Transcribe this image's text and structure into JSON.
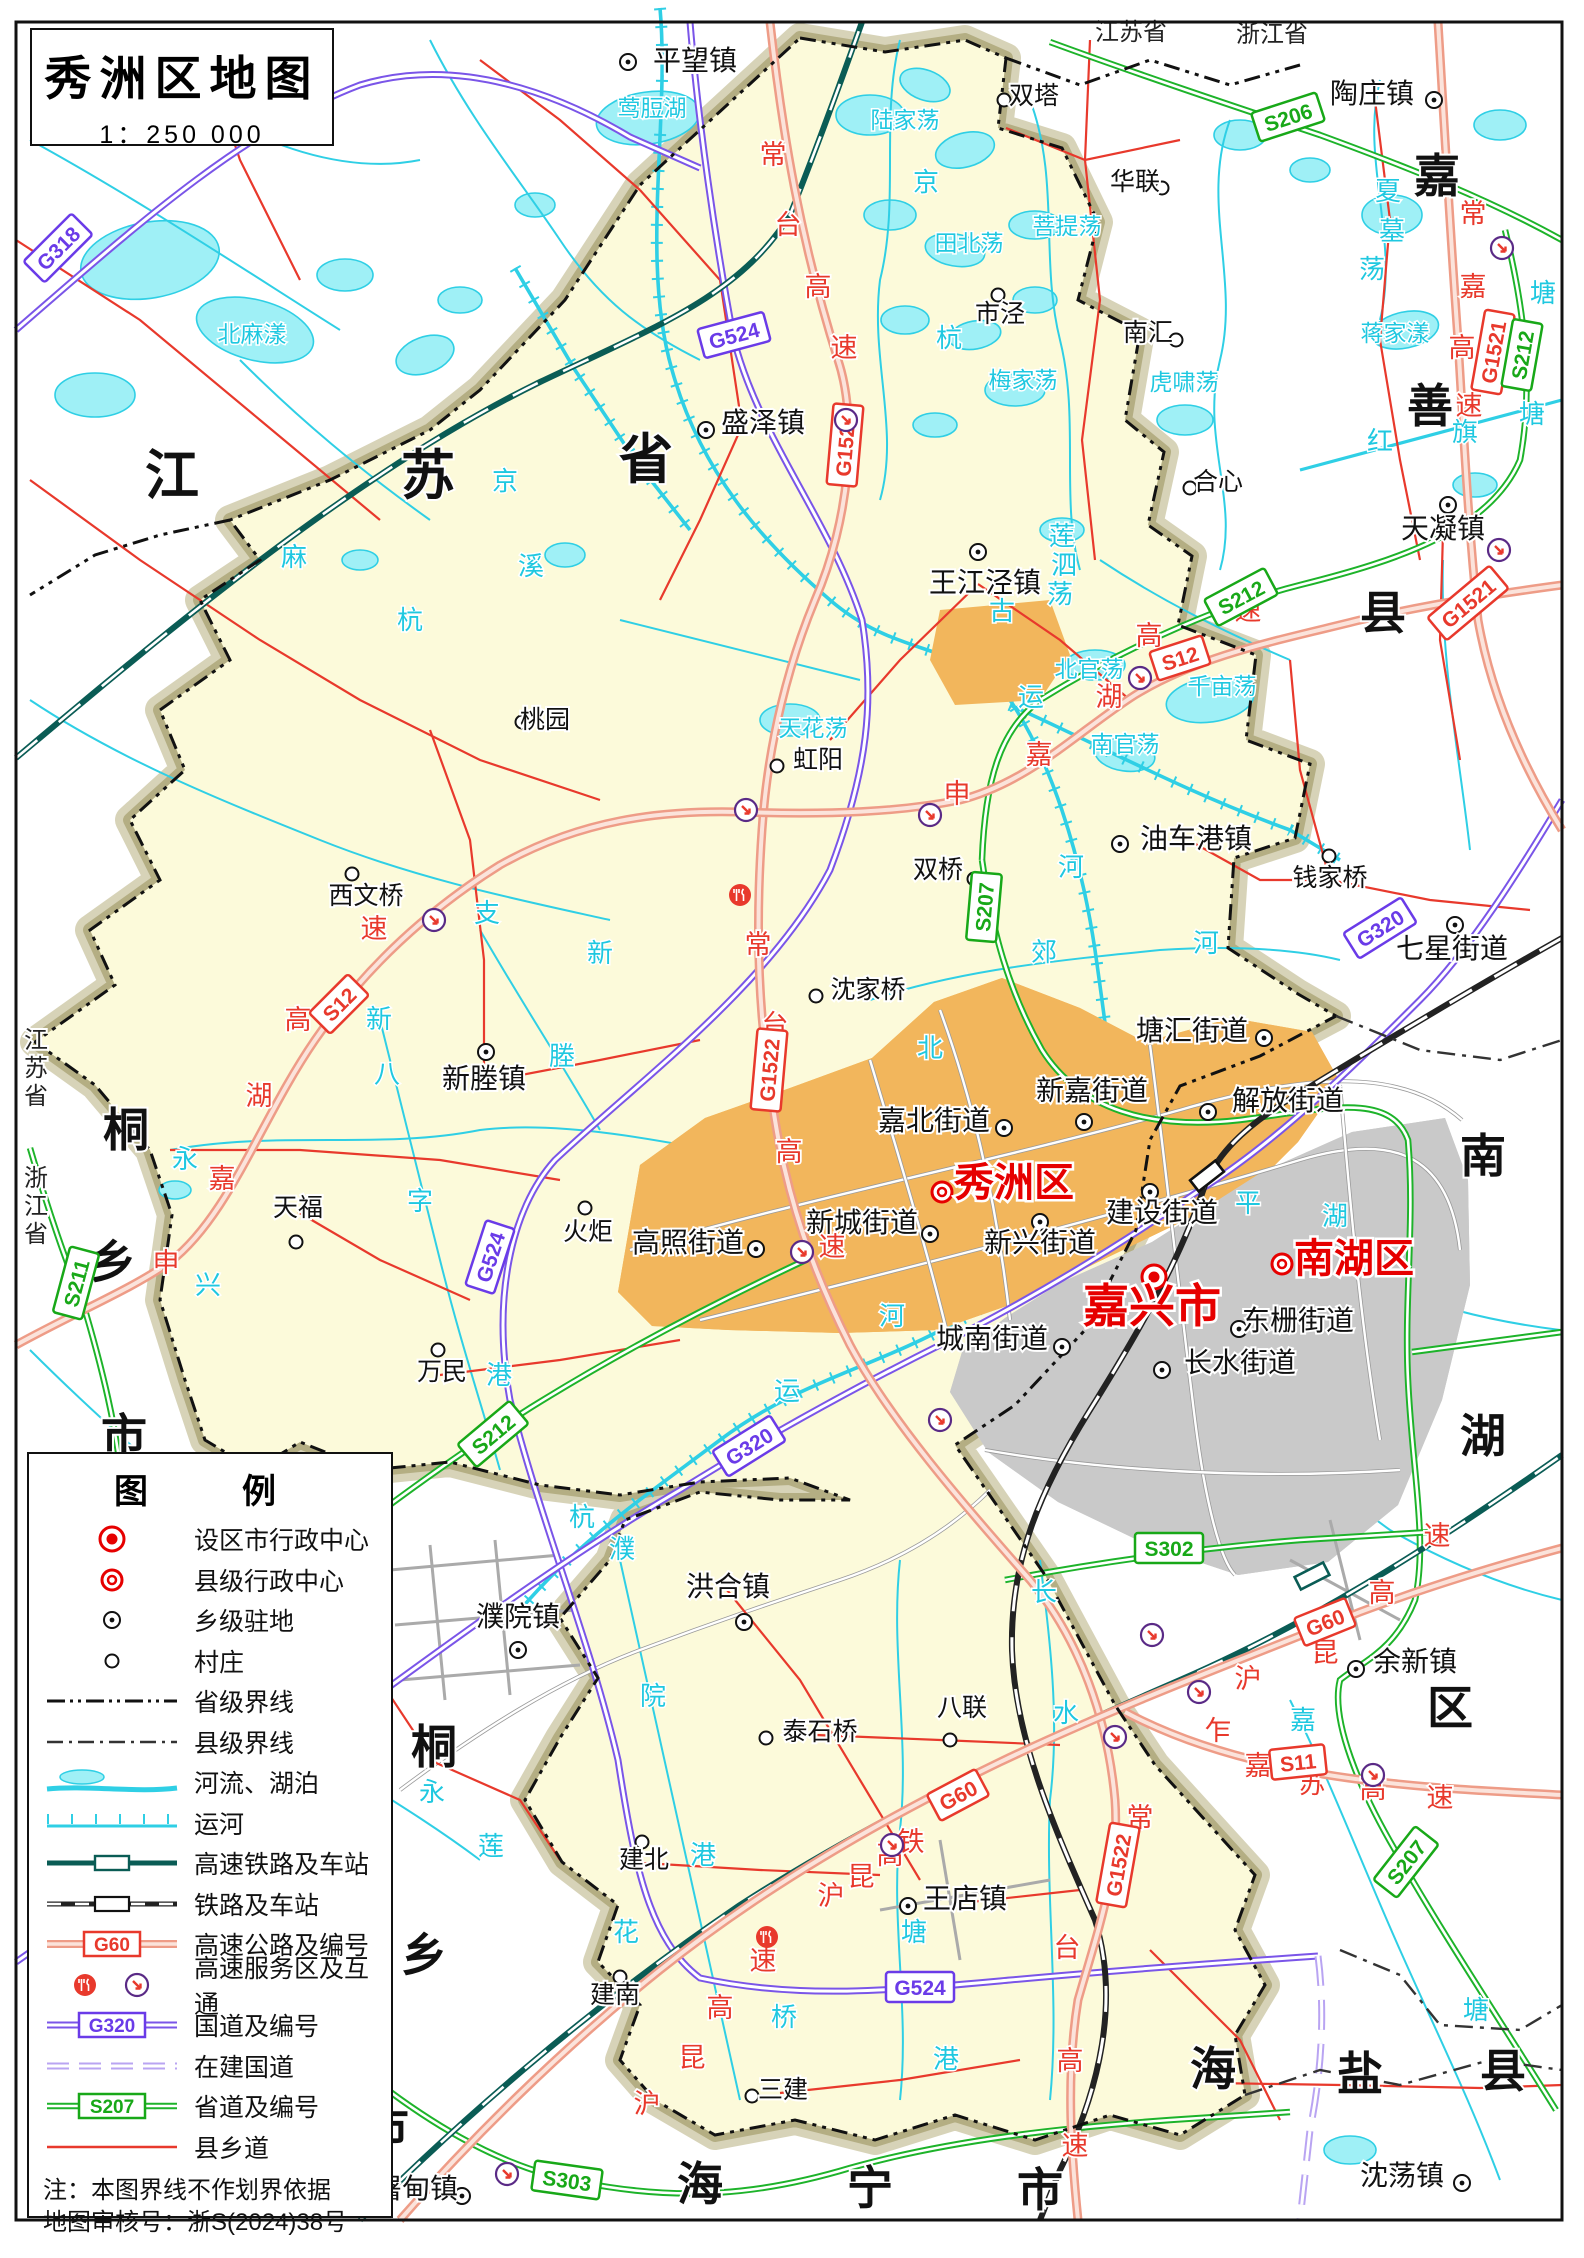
{
  "title": {
    "text": "秀洲区地图",
    "scale": "1：250 000"
  },
  "legend": {
    "title": "图　例",
    "items": [
      {
        "sym": "city",
        "label": "设区市行政中心"
      },
      {
        "sym": "county",
        "label": "县级行政中心"
      },
      {
        "sym": "town",
        "label": "乡级驻地"
      },
      {
        "sym": "village",
        "label": "村庄"
      },
      {
        "sym": "provb",
        "label": "省级界线"
      },
      {
        "sym": "countyb",
        "label": "县级界线"
      },
      {
        "sym": "river",
        "label": "河流、湖泊"
      },
      {
        "sym": "canal",
        "label": "运河"
      },
      {
        "sym": "hsr",
        "label": "高速铁路及车站"
      },
      {
        "sym": "rail",
        "label": "铁路及车站"
      },
      {
        "sym": "expwy",
        "label": "高速公路及编号",
        "code": "G60"
      },
      {
        "sym": "svc",
        "label": "高速服务区及互通"
      },
      {
        "sym": "nat",
        "label": "国道及编号",
        "code": "G320"
      },
      {
        "sym": "natuc",
        "label": "在建国道"
      },
      {
        "sym": "prov",
        "label": "省道及编号",
        "code": "S207"
      },
      {
        "sym": "croad",
        "label": "县乡道"
      }
    ],
    "notes": [
      "注：本图界线不作划界依据",
      "地图审核号：浙S(2024)38号"
    ]
  },
  "map": {
    "places": [
      [
        "平望镇",
        "t",
        695,
        70,
        628,
        62
      ],
      [
        "盛泽镇",
        "t",
        763,
        432,
        706,
        430
      ],
      [
        "陶庄镇",
        "t",
        1372,
        103,
        1434,
        100
      ],
      [
        "天凝镇",
        "t",
        1443,
        538,
        1448,
        505
      ],
      [
        "王江泾镇",
        "t",
        985,
        592,
        978,
        552
      ],
      [
        "油车港镇",
        "t",
        1196,
        848,
        1120,
        844
      ],
      [
        "七星街道",
        "t",
        1452,
        958,
        1455,
        925
      ],
      [
        "新塍镇",
        "t",
        484,
        1088,
        486,
        1052
      ],
      [
        "高照街道",
        "t",
        688,
        1252,
        756,
        1249
      ],
      [
        "新城街道",
        "t",
        862,
        1232,
        930,
        1234
      ],
      [
        "嘉北街道",
        "t",
        934,
        1130,
        1004,
        1128
      ],
      [
        "新嘉街道",
        "t",
        1092,
        1100,
        1084,
        1122
      ],
      [
        "解放街道",
        "t",
        1288,
        1110,
        1208,
        1112
      ],
      [
        "塘汇街道",
        "t",
        1192,
        1040,
        1264,
        1038
      ],
      [
        "新兴街道",
        "t",
        1040,
        1252,
        1040,
        1222
      ],
      [
        "建设街道",
        "t",
        1162,
        1222,
        1150,
        1192
      ],
      [
        "城南街道",
        "t",
        992,
        1348,
        1062,
        1347
      ],
      [
        "东栅街道",
        "t",
        1298,
        1330,
        1239,
        1329
      ],
      [
        "长水街道",
        "t",
        1240,
        1372,
        1162,
        1370
      ],
      [
        "洪合镇",
        "t",
        728,
        1596,
        744,
        1622
      ],
      [
        "濮院镇",
        "t",
        518,
        1626,
        518,
        1650
      ],
      [
        "王店镇",
        "t",
        965,
        1908,
        908,
        1906
      ],
      [
        "余新镇",
        "t",
        1415,
        1671,
        1356,
        1669
      ],
      [
        "屠甸镇",
        "t",
        416,
        2198,
        462,
        2196
      ],
      [
        "沈荡镇",
        "t",
        1402,
        2185,
        1462,
        2183
      ],
      [
        "双塔",
        "v",
        1034,
        104,
        1004,
        100
      ],
      [
        "市泾",
        "v",
        1000,
        322,
        998,
        295
      ],
      [
        "华联",
        "v",
        1135,
        190,
        1162,
        188
      ],
      [
        "南汇",
        "v",
        1148,
        341,
        1176,
        340
      ],
      [
        "合心",
        "v",
        1218,
        490,
        1190,
        488
      ],
      [
        "桃园",
        "v",
        545,
        728,
        522,
        722
      ],
      [
        "虹阳",
        "v",
        818,
        768,
        777,
        766
      ],
      [
        "双桥",
        "v",
        938,
        878,
        974,
        879
      ],
      [
        "西文桥",
        "v",
        366,
        904,
        352,
        874
      ],
      [
        "沈家桥",
        "v",
        868,
        998,
        816,
        996
      ],
      [
        "钱家桥",
        "v",
        1330,
        886,
        1329,
        856
      ],
      [
        "天福",
        "v",
        298,
        1216,
        296,
        1242
      ],
      [
        "火炬",
        "v",
        588,
        1240,
        585,
        1208
      ],
      [
        "万民",
        "v",
        442,
        1380,
        438,
        1350
      ],
      [
        "泰石桥",
        "v",
        820,
        1740,
        766,
        1738
      ],
      [
        "八联",
        "v",
        962,
        1716,
        950,
        1740
      ],
      [
        "建北",
        "v",
        644,
        1868,
        642,
        1842
      ],
      [
        "建南",
        "v",
        615,
        2003,
        620,
        1977
      ],
      [
        "三建",
        "v",
        783,
        2098,
        752,
        2096
      ],
      [
        "嘉兴市",
        "c",
        1152,
        1322,
        1154,
        1277
      ],
      [
        "秀洲区",
        "d",
        1014,
        1196,
        942,
        1192
      ],
      [
        "南湖区",
        "d",
        1354,
        1272,
        1282,
        1264
      ]
    ],
    "labels": [
      {
        "cls": "t-provbig",
        "items": [
          [
            "江",
            172,
            494
          ],
          [
            "苏",
            428,
            494
          ],
          [
            "省",
            646,
            478
          ]
        ]
      },
      {
        "cls": "t-region",
        "items": [
          [
            "桐",
            126,
            1146
          ],
          [
            "乡",
            113,
            1278
          ],
          [
            "市",
            124,
            1452
          ],
          [
            "桐",
            434,
            1763
          ],
          [
            "乡",
            424,
            1971
          ],
          [
            "市",
            386,
            2144
          ],
          [
            "海",
            700,
            2200
          ],
          [
            "宁",
            870,
            2204
          ],
          [
            "市",
            1040,
            2206
          ],
          [
            "海",
            1213,
            2085
          ],
          [
            "盐",
            1360,
            2090
          ],
          [
            "县",
            1503,
            2087
          ],
          [
            "嘉",
            1437,
            192
          ],
          [
            "善",
            1430,
            422
          ],
          [
            "县",
            1383,
            629
          ],
          [
            "南",
            1483,
            1172
          ],
          [
            "湖",
            1483,
            1452
          ],
          [
            "区",
            1450,
            1724
          ]
        ]
      },
      {
        "cls": "t-provsm",
        "items": [
          [
            "江苏省",
            1131,
            40
          ],
          [
            "浙江省",
            1272,
            42
          ],
          [
            "江",
            36,
            1048
          ],
          [
            "苏",
            36,
            1076
          ],
          [
            "省",
            36,
            1104
          ],
          [
            "浙",
            36,
            1186
          ],
          [
            "江",
            36,
            1214
          ],
          [
            "省",
            36,
            1242
          ]
        ]
      },
      {
        "cls": "t-water",
        "items": [
          [
            "北麻漾",
            252,
            342
          ],
          [
            "莺脰湖",
            652,
            116
          ],
          [
            "陆家荡",
            905,
            128
          ],
          [
            "田北荡",
            969,
            251
          ],
          [
            "菩提荡",
            1067,
            234
          ],
          [
            "梅家荡",
            1023,
            388
          ],
          [
            "蒋家漾",
            1395,
            341
          ],
          [
            "虎啸荡",
            1184,
            390
          ],
          [
            "天花荡",
            813,
            736
          ],
          [
            "北官荡",
            1089,
            677
          ],
          [
            "南官荡",
            1125,
            752
          ],
          [
            "千亩荡",
            1222,
            694
          ]
        ]
      },
      {
        "cls": "t-waterch",
        "items": [
          [
            "夏",
            1388,
            200
          ],
          [
            "墓",
            1392,
            240
          ],
          [
            "荡",
            1372,
            278
          ],
          [
            "莲",
            1062,
            545
          ],
          [
            "泗",
            1064,
            574
          ],
          [
            "荡",
            1060,
            603
          ],
          [
            "红",
            1380,
            450
          ],
          [
            "旗",
            1465,
            441
          ],
          [
            "塘",
            1532,
            423
          ],
          [
            "塘",
            1543,
            302
          ],
          [
            "京",
            505,
            490
          ],
          [
            "麻",
            294,
            566
          ],
          [
            "溪",
            531,
            575
          ],
          [
            "杭",
            410,
            629
          ],
          [
            "京",
            926,
            191
          ],
          [
            "杭",
            949,
            347
          ],
          [
            "古",
            1002,
            620
          ],
          [
            "运",
            1031,
            706
          ],
          [
            "河",
            1071,
            876
          ],
          [
            "郊",
            1044,
            961
          ],
          [
            "北",
            930,
            1057
          ],
          [
            "河",
            1206,
            952
          ],
          [
            "支",
            487,
            922
          ],
          [
            "新",
            600,
            962
          ],
          [
            "塍",
            562,
            1065
          ],
          [
            "新",
            379,
            1028
          ],
          [
            "八",
            387,
            1083
          ],
          [
            "字",
            420,
            1210
          ],
          [
            "港",
            499,
            1384
          ],
          [
            "运",
            787,
            1400
          ],
          [
            "河",
            892,
            1325
          ],
          [
            "杭",
            582,
            1526
          ],
          [
            "濮",
            622,
            1558
          ],
          [
            "院",
            653,
            1705
          ],
          [
            "港",
            703,
            1864
          ],
          [
            "花",
            626,
            1941
          ],
          [
            "塘",
            914,
            1941
          ],
          [
            "桥",
            784,
            2026
          ],
          [
            "港",
            946,
            2068
          ],
          [
            "长",
            1044,
            1601
          ],
          [
            "水",
            1066,
            1722
          ],
          [
            "嘉",
            1303,
            1729
          ],
          [
            "塘",
            1476,
            2019
          ],
          [
            "永",
            185,
            1168
          ],
          [
            "兴",
            208,
            1294
          ],
          [
            "永",
            432,
            1801
          ],
          [
            "莲",
            491,
            1855
          ],
          [
            "平",
            1248,
            1212
          ],
          [
            "湖",
            1335,
            1225
          ]
        ]
      },
      {
        "cls": "t-road",
        "items": [
          [
            "常",
            773,
            164
          ],
          [
            "台",
            788,
            234
          ],
          [
            "高",
            818,
            296
          ],
          [
            "速",
            844,
            357
          ],
          [
            "常",
            758,
            954
          ],
          [
            "台",
            775,
            1034
          ],
          [
            "高",
            789,
            1161
          ],
          [
            "速",
            832,
            1256
          ],
          [
            "常",
            1140,
            1827
          ],
          [
            "台",
            1067,
            1957
          ],
          [
            "高",
            1070,
            2070
          ],
          [
            "速",
            1075,
            2155
          ],
          [
            "常",
            1473,
            223
          ],
          [
            "嘉",
            1473,
            296
          ],
          [
            "高",
            1462,
            357
          ],
          [
            "速",
            1469,
            415
          ],
          [
            "申",
            166,
            1272
          ],
          [
            "嘉",
            222,
            1188
          ],
          [
            "湖",
            259,
            1105
          ],
          [
            "高",
            298,
            1029
          ],
          [
            "速",
            374,
            938
          ],
          [
            "申",
            957,
            803
          ],
          [
            "嘉",
            1039,
            764
          ],
          [
            "湖",
            1109,
            706
          ],
          [
            "高",
            1149,
            645
          ],
          [
            "速",
            1248,
            620
          ],
          [
            "沪",
            647,
            2113
          ],
          [
            "昆",
            692,
            2067
          ],
          [
            "高",
            720,
            2017
          ],
          [
            "速",
            763,
            1970
          ],
          [
            "沪",
            831,
            1905
          ],
          [
            "昆",
            861,
            1886
          ],
          [
            "高",
            890,
            1864
          ],
          [
            "铁",
            911,
            1851
          ],
          [
            "沪",
            1248,
            1688
          ],
          [
            "昆",
            1325,
            1662
          ],
          [
            "高",
            1382,
            1602
          ],
          [
            "速",
            1437,
            1545
          ],
          [
            "乍",
            1218,
            1740
          ],
          [
            "嘉",
            1258,
            1775
          ],
          [
            "苏",
            1312,
            1793
          ],
          [
            "高",
            1373,
            1798
          ],
          [
            "速",
            1440,
            1807
          ]
        ]
      }
    ],
    "badges": [
      [
        "G318",
        "n",
        58,
        248,
        -45
      ],
      [
        "G524",
        "n",
        734,
        335,
        -15
      ],
      [
        "G524",
        "n",
        490,
        1257,
        -72
      ],
      [
        "G524",
        "n",
        920,
        1987,
        0
      ],
      [
        "G320",
        "n",
        1380,
        928,
        -32
      ],
      [
        "G320",
        "n",
        749,
        1446,
        -32
      ],
      [
        "G1521",
        "e",
        1493,
        352,
        -80
      ],
      [
        "G1521",
        "e",
        1468,
        603,
        -40
      ],
      [
        "G1522",
        "e",
        845,
        445,
        -85
      ],
      [
        "G1522",
        "e",
        769,
        1070,
        -85
      ],
      [
        "G1522",
        "e",
        1118,
        1865,
        -80
      ],
      [
        "S12",
        "e",
        339,
        1004,
        -45
      ],
      [
        "S12",
        "e",
        1180,
        658,
        -18
      ],
      [
        "S11",
        "e",
        1298,
        1762,
        -6
      ],
      [
        "G60",
        "e",
        958,
        1795,
        -28
      ],
      [
        "G60",
        "e",
        1325,
        1622,
        -22
      ],
      [
        "S206",
        "p",
        1288,
        117,
        -18
      ],
      [
        "S212",
        "p",
        1522,
        355,
        -80
      ],
      [
        "S212",
        "p",
        1241,
        597,
        -28
      ],
      [
        "S212",
        "p",
        493,
        1434,
        -40
      ],
      [
        "S207",
        "p",
        984,
        907,
        -85
      ],
      [
        "S207",
        "p",
        1406,
        1862,
        -52
      ],
      [
        "S302",
        "p",
        1169,
        1548,
        0
      ],
      [
        "S303",
        "p",
        567,
        2180,
        8
      ],
      [
        "S211",
        "p",
        76,
        1283,
        -75
      ]
    ],
    "interchanges": [
      [
        846,
        420
      ],
      [
        1502,
        248
      ],
      [
        1499,
        550
      ],
      [
        746,
        810
      ],
      [
        930,
        815
      ],
      [
        434,
        920
      ],
      [
        1140,
        678
      ],
      [
        802,
        1252
      ],
      [
        940,
        1420
      ],
      [
        1152,
        1635
      ],
      [
        1199,
        1692
      ],
      [
        1115,
        1737
      ],
      [
        1373,
        1775
      ],
      [
        507,
        2174
      ],
      [
        892,
        1845
      ]
    ],
    "services": [
      [
        740,
        895
      ],
      [
        767,
        1937
      ]
    ],
    "stations": [
      {
        "x": 1207,
        "y": 1176,
        "rot": -38,
        "kind": "rail"
      },
      {
        "x": 1312,
        "y": 1576,
        "rot": -27,
        "kind": "hsr"
      }
    ]
  }
}
